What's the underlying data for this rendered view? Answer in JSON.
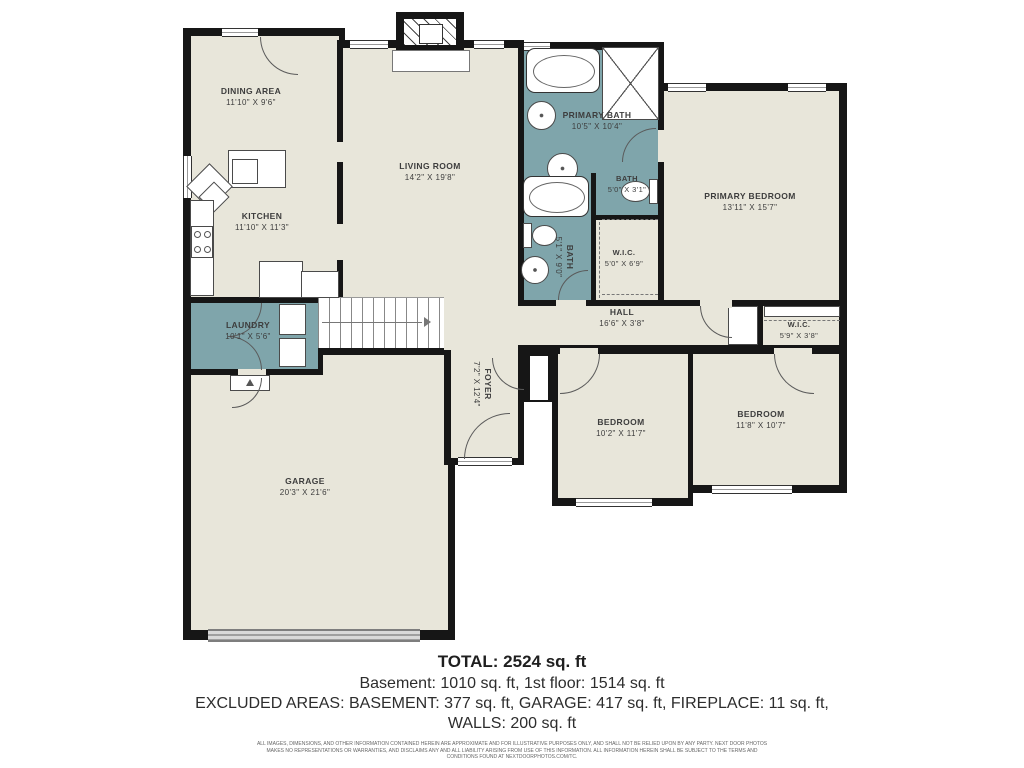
{
  "colors": {
    "floor": "#e8e6da",
    "wet_room": "#7fa5ab",
    "wall": "#161616",
    "label": "#3d3d3d",
    "garage_door": "#c9c9c9",
    "background": "#ffffff"
  },
  "rooms": {
    "dining": {
      "name": "DINING AREA",
      "dims": "11'10\" X 9'6\""
    },
    "living": {
      "name": "LIVING ROOM",
      "dims": "14'2\" X 19'8\""
    },
    "kitchen": {
      "name": "KITCHEN",
      "dims": "11'10\" X 11'3\""
    },
    "primary_bath": {
      "name": "PRIMARY BATH",
      "dims": "10'5\" X 10'4\""
    },
    "bath_small": {
      "name": "BATH",
      "dims": "5'0\" X 3'1\""
    },
    "bath_hall": {
      "name": "BATH",
      "dims": "5'1\" X 9'0\""
    },
    "wic_primary": {
      "name": "W.I.C.",
      "dims": "5'0\" X 6'9\""
    },
    "primary_bedroom": {
      "name": "PRIMARY BEDROOM",
      "dims": "13'11\" X 15'7\""
    },
    "hall": {
      "name": "HALL",
      "dims": "16'6\" X 3'8\""
    },
    "wic_hall": {
      "name": "W.I.C.",
      "dims": "5'9\" X 3'8\""
    },
    "laundry": {
      "name": "LAUNDRY",
      "dims": "10'1\" X 5'6\""
    },
    "foyer": {
      "name": "FOYER",
      "dims": "7'2\" X 12'4\""
    },
    "bedroom_mid": {
      "name": "BEDROOM",
      "dims": "10'2\" X 11'7\""
    },
    "bedroom_right": {
      "name": "BEDROOM",
      "dims": "11'8\" X 10'7\""
    },
    "garage": {
      "name": "GARAGE",
      "dims": "20'3\" X 21'6\""
    }
  },
  "summary": {
    "total": "TOTAL: 2524 sq. ft",
    "floors": "Basement: 1010 sq. ft, 1st floor: 1514 sq. ft",
    "excluded": "EXCLUDED AREAS: BASEMENT: 377 sq. ft, GARAGE: 417 sq. ft, FIREPLACE: 11 sq. ft,",
    "walls": "WALLS: 200 sq. ft"
  },
  "disclaimer": "ALL IMAGES, DIMENSIONS, AND OTHER INFORMATION CONTAINED HEREIN ARE APPROXIMATE AND FOR ILLUSTRATIVE PURPOSES ONLY, AND SHALL NOT BE RELIED UPON BY ANY PARTY. NEXT DOOR PHOTOS MAKES NO REPRESENTATIONS OR WARRANTIES, AND DISCLAIMS ANY AND ALL LIABILITY ARISING FROM USE OF THIS INFORMATION. ALL INFORMATION HEREIN SHALL BE SUBJECT TO THE TERMS AND CONDITIONS FOUND AT NEXTDOORPHOTOS.COM/TC."
}
